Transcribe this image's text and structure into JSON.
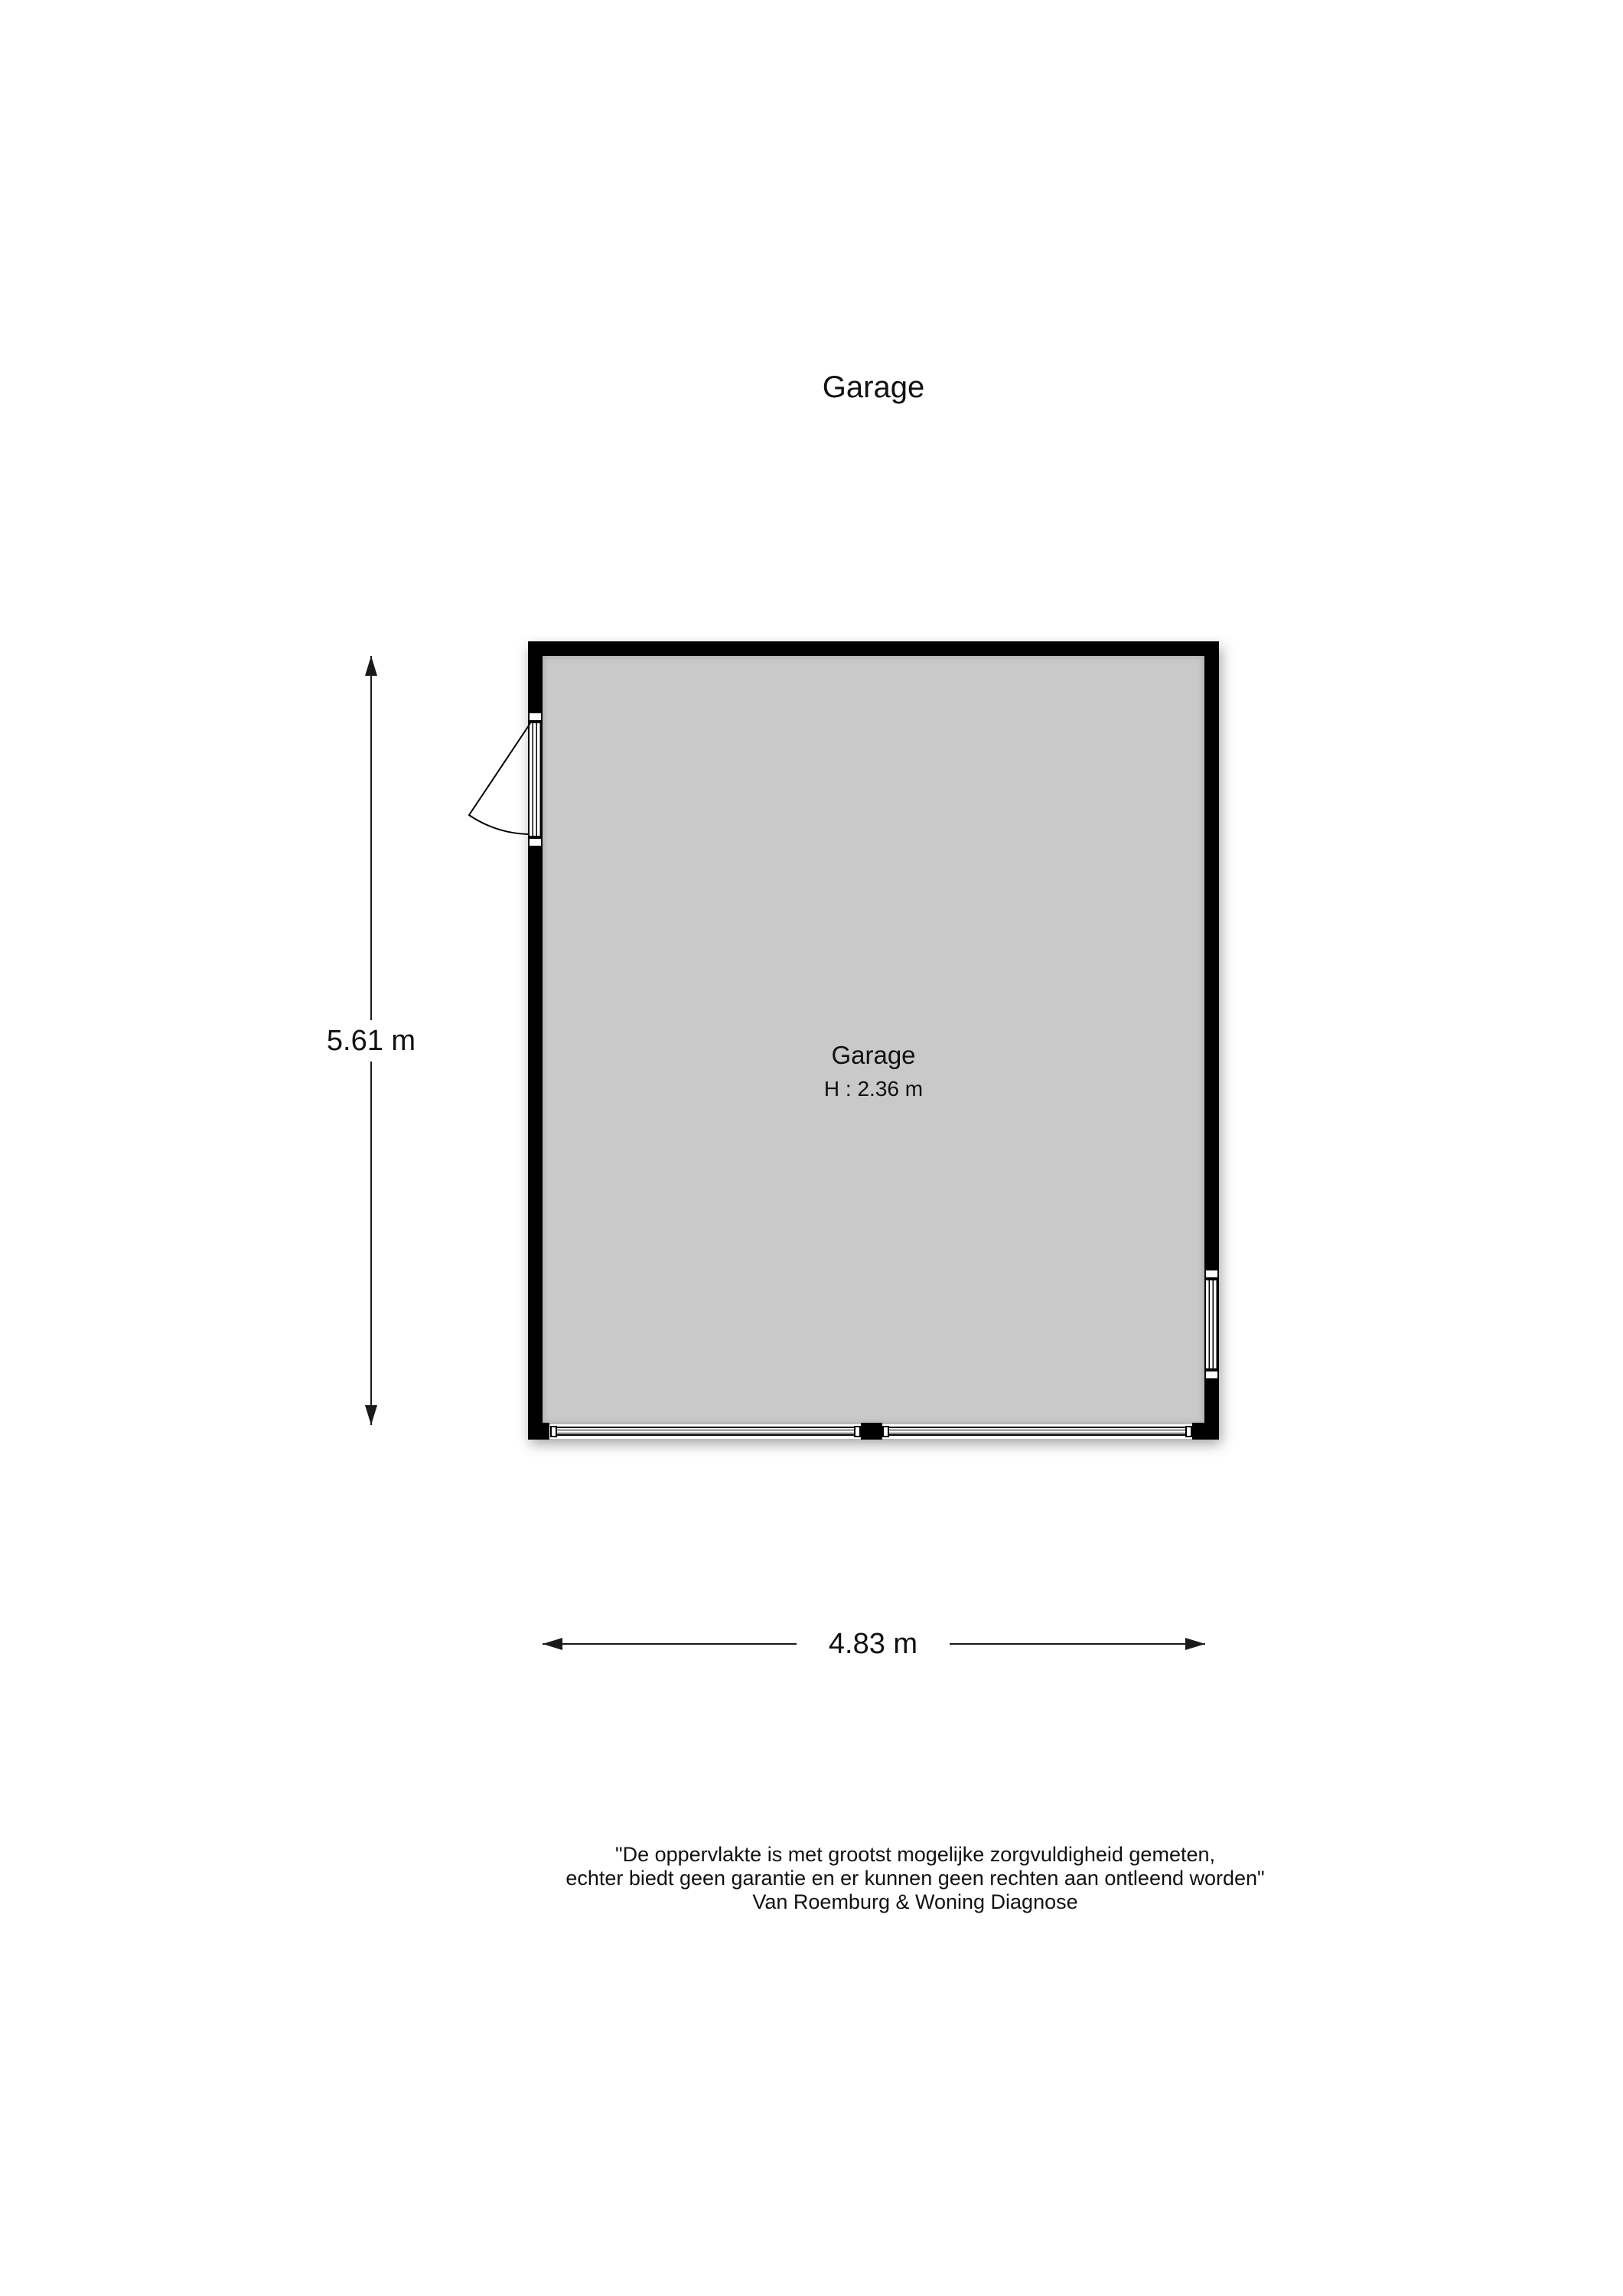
{
  "title": "Garage",
  "plan": {
    "room": {
      "name": "Garage",
      "height_label": "H : 2.36 m"
    },
    "dimensions": {
      "vertical_label": "5.61 m",
      "horizontal_label": "4.83 m"
    },
    "features": {
      "door": "hinged door, left wall, swings outward",
      "window": "window, right wall lower section",
      "garage_doors": "two garage door panels in bottom wall with center pillar"
    },
    "colors": {
      "wall": "#000000",
      "floor": "#c9c9c9",
      "line": "#1a1a1a",
      "background": "#ffffff"
    }
  },
  "footer": {
    "line1": "\"De oppervlakte is met grootst mogelijke zorgvuldigheid gemeten,",
    "line2": "echter biedt geen garantie en er kunnen geen rechten aan ontleend worden\"",
    "line3": "Van Roemburg & Woning Diagnose"
  }
}
